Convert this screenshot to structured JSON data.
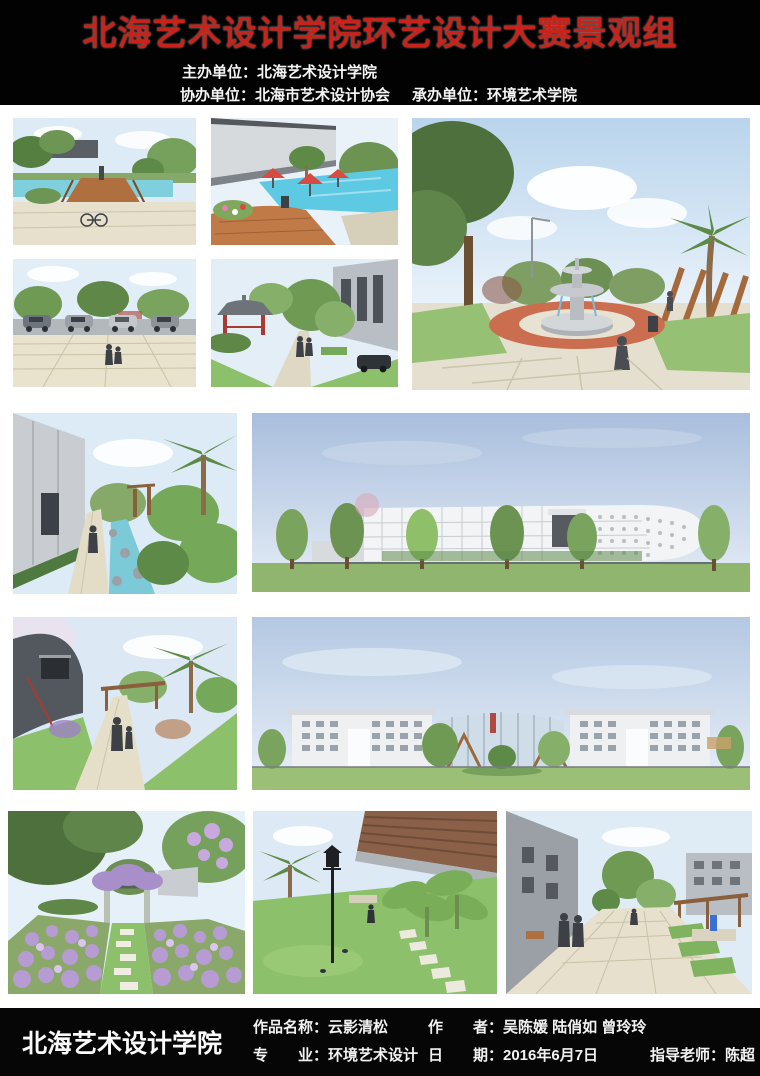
{
  "header": {
    "title": "北海艺术设计学院环艺设计大赛景观组",
    "title_color": "#c8231b",
    "host_line": "主办单位：北海艺术设计学院",
    "co_host_line": "协办单位：北海市艺术设计协会",
    "undertaker_line": "承办单位：环境艺术学院"
  },
  "gallery": {
    "images": [
      {
        "id": "park-bridge",
        "description": "Park pond with wooden bridge, palm trees and parked bicycles"
      },
      {
        "id": "pool-umbrellas",
        "description": "Swimming pool with red umbrellas beside a large grey building"
      },
      {
        "id": "fountain-plaza",
        "description": "Plaza with tiered stone fountain on a red circular paving ring, palms and timber trellis"
      },
      {
        "id": "parking-plaza",
        "description": "Parking lot with cars in front of a paved pedestrian plaza"
      },
      {
        "id": "pavilion-path",
        "description": "Garden path with traditional Chinese pavilion and street trees"
      },
      {
        "id": "palm-walkway",
        "description": "Paved walkway beside a building with hedge, stream and lush palms"
      },
      {
        "id": "white-building-elevation",
        "description": "Elevation of a long white modern building with perforated facade and tree row"
      },
      {
        "id": "curved-garden-path",
        "description": "Curved garden path with pergola, palms and strolling figures"
      },
      {
        "id": "campus-panorama",
        "description": "Panorama of symmetric white campus buildings with central glass hall"
      },
      {
        "id": "purple-flower-garden",
        "description": "Lavender flower garden with stepping-stone path and wisteria pergola"
      },
      {
        "id": "lawn-lamp",
        "description": "Lawn with ornate street lamp, stepping stones and banana plants"
      },
      {
        "id": "pedestrian-street",
        "description": "Paved pedestrian street with people, pergola and terraced green seating"
      }
    ]
  },
  "footer": {
    "school_name": "北海艺术设计学院",
    "work_title": "作品名称：云影清松",
    "authors": "作　　者：吴陈媛 陆俏如 曾玲玲",
    "major": "专　　业：环境艺术设计",
    "date": "日　　期：2016年6月7日",
    "advisor": "指导老师：陈超"
  }
}
